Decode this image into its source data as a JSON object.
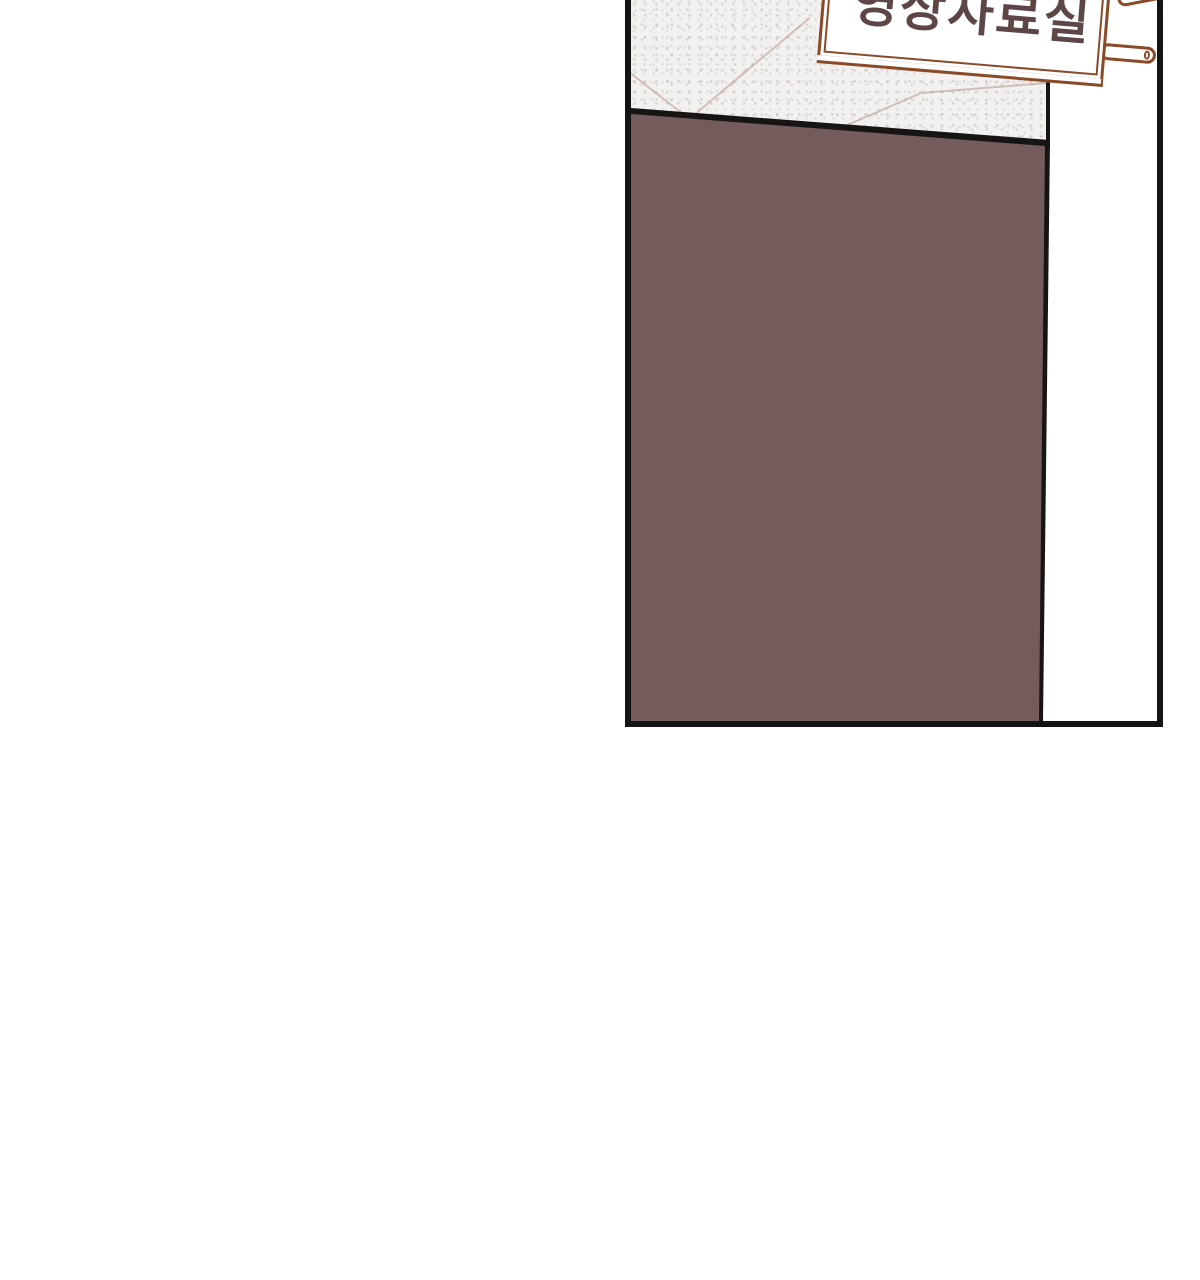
{
  "sign": {
    "label": "영상자료실"
  },
  "colors": {
    "page-bg": "#ffffff",
    "panel-border": "#141414",
    "wall": "#f3f1ef",
    "groove": "#b59a93",
    "door": "#745c5c",
    "door-edge": "#171414",
    "sign-frame": "#8a4a28",
    "sign-face": "#ffffff",
    "sign-text": "#5e4646"
  }
}
